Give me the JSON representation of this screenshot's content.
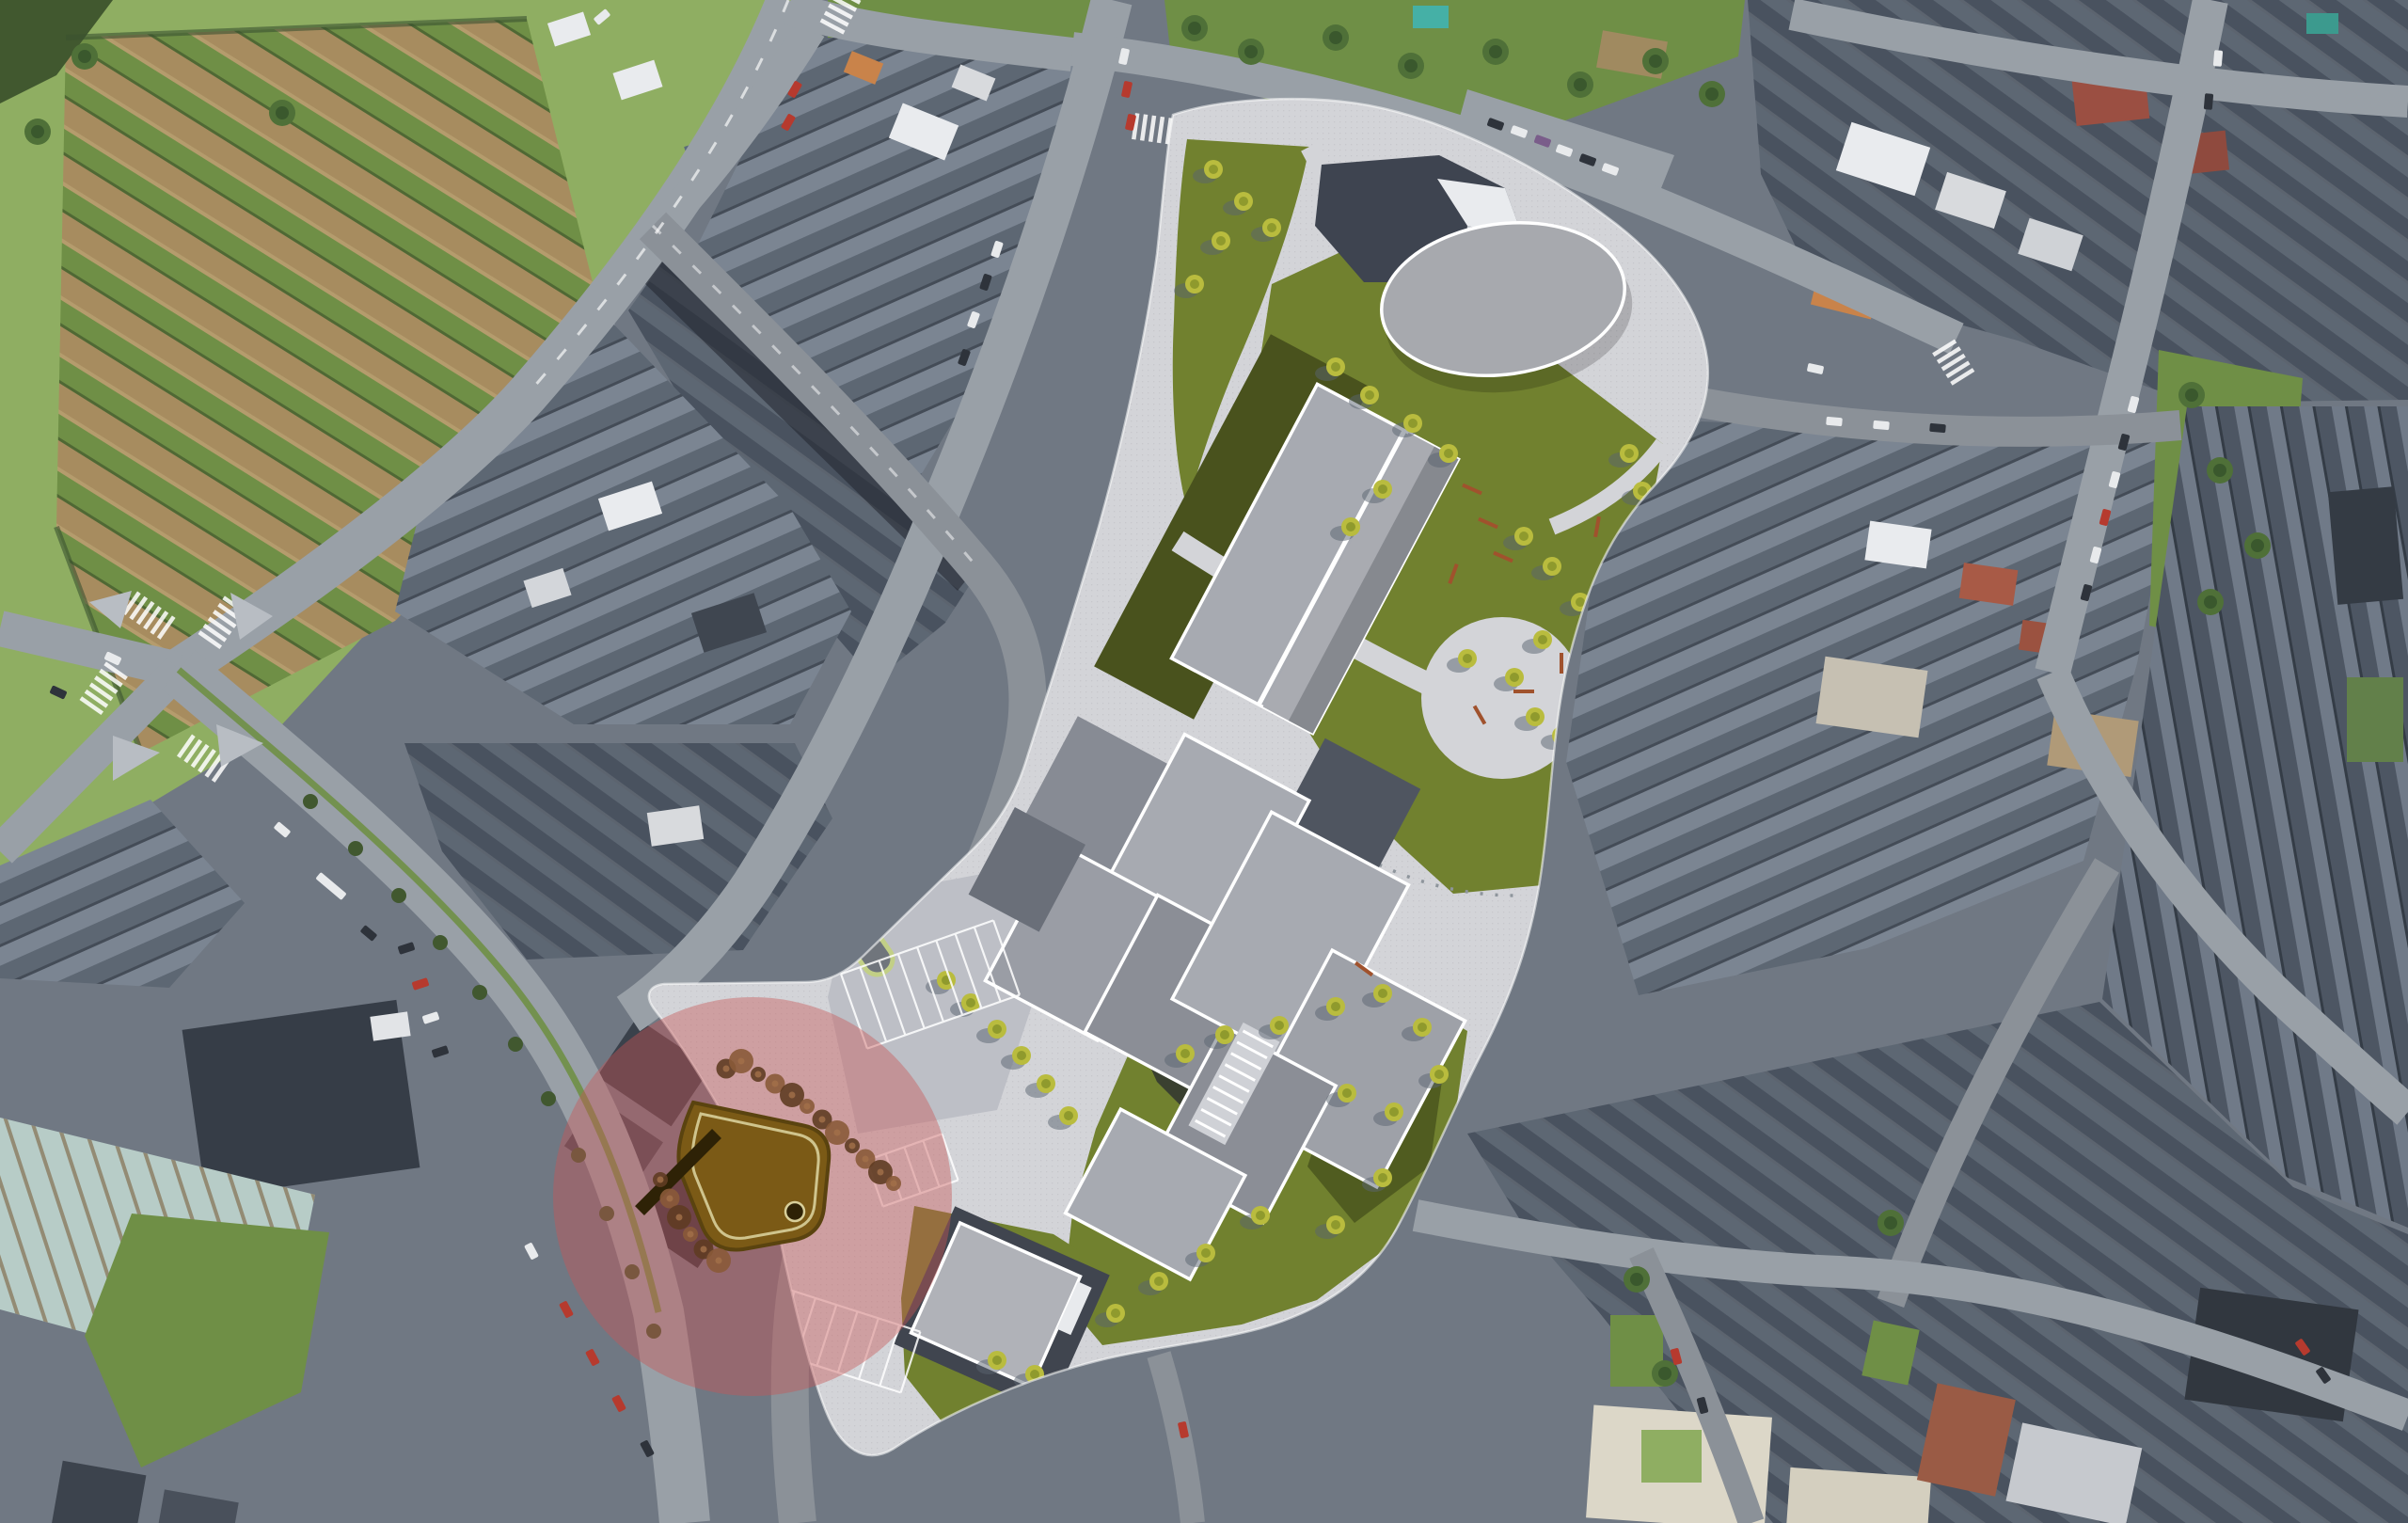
{
  "scene": {
    "type": "satellite-aerial-photo-with-masterplan-render-overlay",
    "regions": [
      {
        "name": "agricultural-fields-northwest"
      },
      {
        "name": "existing-town-blocks"
      },
      {
        "name": "road-network"
      },
      {
        "name": "masterplan-site"
      },
      {
        "name": "masterplan-oval-hall"
      },
      {
        "name": "masterplan-north-slab-building"
      },
      {
        "name": "masterplan-housing-cluster"
      },
      {
        "name": "masterplan-south-pavilion"
      },
      {
        "name": "masterplan-lawns-and-trees"
      },
      {
        "name": "circular-plaza"
      },
      {
        "name": "parking-areas"
      },
      {
        "name": "highlight-circle"
      },
      {
        "name": "sunken-plaza-monument"
      }
    ],
    "highlight": {
      "shape": "circle",
      "opacity": 0.42
    }
  },
  "palette": {
    "base": "#707883",
    "road": "#99a0a7",
    "roadDark": "#8b9198",
    "sidewalk": "#b8bdc3",
    "pavement": "#d3d4d8",
    "pavementShade": "#bdbfc6",
    "lawn": "#71812f",
    "lawnShade": "#49521d",
    "treeLight": "#b9bc3e",
    "treeDark": "#7d8c27",
    "treeReal": "#4f7038",
    "treeRealDark": "#35522a",
    "roofDark": "#49525f",
    "roofMid": "#5d6773",
    "roofLight": "#7b8592",
    "roofDeep": "#353c46",
    "white": "#e9ebee",
    "cream": "#dcd7c8",
    "orangeRoof": "#c9834a",
    "redRoof": "#9b4f42",
    "brickRoof": "#9a5b45",
    "fieldBrown": "#a78c5f",
    "fieldTan": "#b59c6d",
    "fieldGreen": "#6f8f46",
    "grassBright": "#8fae62",
    "hedge": "#41582f",
    "ribbedBase": "#b7ccc7",
    "ribbedLine": "#8a7a5f",
    "marketDark": "#363d47",
    "overlayRed": "#c85555",
    "plazaBrown": "#7b5a16",
    "plazaBrownDark": "#2e2206",
    "plazaOutline": "#d8cf9a",
    "bushBrown": "#8a5a38",
    "bushBrownDark": "#5f3c22",
    "carRed": "#b63a2e",
    "carWhite": "#e8eaec",
    "carDark": "#2e333b",
    "carPurple": "#7a5d8a",
    "benchBrown": "#a0522d",
    "rampGreen": "#c2cf86",
    "buildingLight": "#a7aab1",
    "buildingMid": "#8b8e96",
    "ovalFill": "#a7a9ae",
    "pavilionDark": "#3e4450"
  }
}
